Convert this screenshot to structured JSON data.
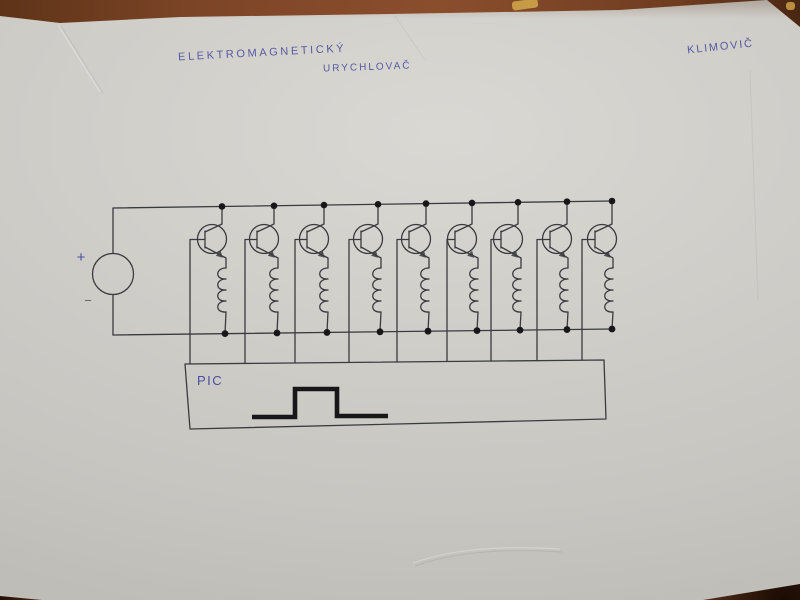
{
  "title": {
    "line1": "ELEKTROMAGNETICKÝ",
    "line2": "URYCHLOVAČ"
  },
  "author": "KLIMOVIČ",
  "circuit": {
    "type": "hand-drawn schematic: electromagnetic accelerator coil driver",
    "power_source": {
      "plus": "+",
      "minus": "−"
    },
    "stage_count": 9,
    "stages": [
      {
        "top_x": 222,
        "bottom_x": 225,
        "base_x": 190
      },
      {
        "top_x": 274,
        "bottom_x": 277,
        "base_x": 245
      },
      {
        "top_x": 324,
        "bottom_x": 327,
        "base_x": 295
      },
      {
        "top_x": 378,
        "bottom_x": 380,
        "base_x": 349
      },
      {
        "top_x": 426,
        "bottom_x": 428,
        "base_x": 397
      },
      {
        "top_x": 472,
        "bottom_x": 477,
        "base_x": 447
      },
      {
        "top_x": 518,
        "bottom_x": 520,
        "base_x": 491
      },
      {
        "top_x": 567,
        "bottom_x": 567,
        "base_x": 537
      },
      {
        "top_x": 612,
        "bottom_x": 612,
        "base_x": 582
      }
    ],
    "controller": {
      "label": "PIC"
    },
    "waveform": {
      "shape": "square-pulse",
      "points": [
        [
          252,
          417
        ],
        [
          295,
          417
        ],
        [
          295,
          389
        ],
        [
          337,
          389
        ],
        [
          337,
          416
        ],
        [
          388,
          416
        ]
      ]
    }
  },
  "colors": {
    "paper": "#cfcdc8",
    "table_wood": "#7d4526",
    "ink_blue": "#4b4f9f",
    "pencil_line": "#3a3b40",
    "marker_black": "#17171a"
  }
}
